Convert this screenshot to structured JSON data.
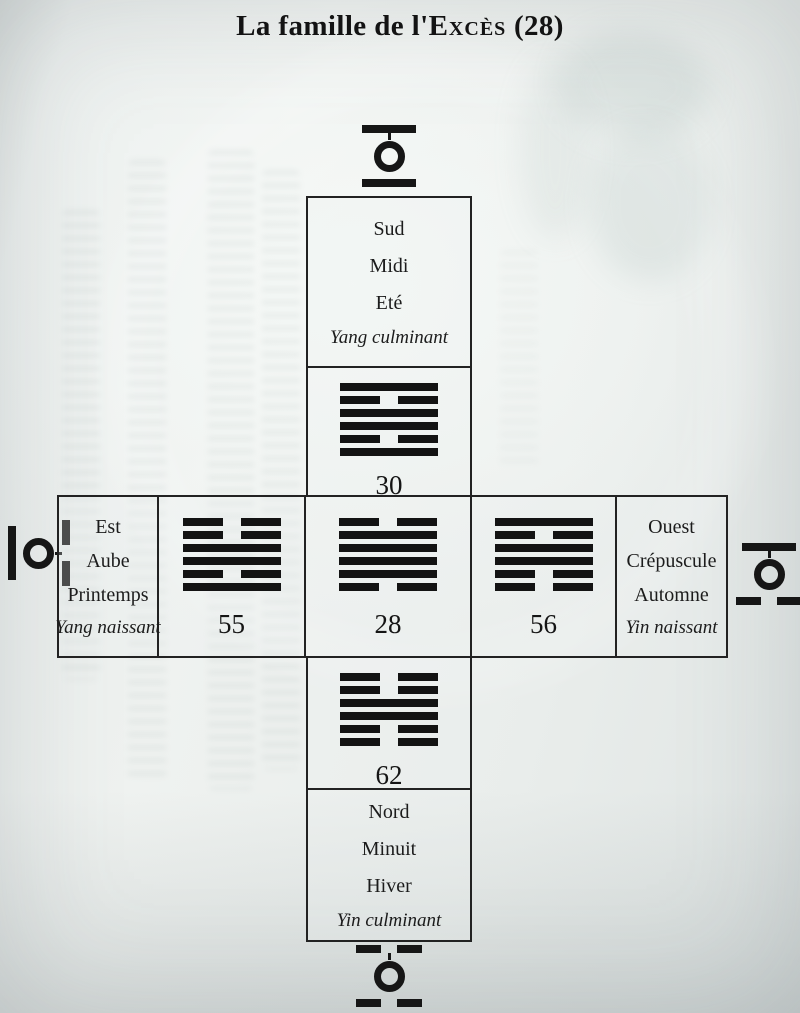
{
  "page": {
    "title_prefix": "La famille de l'",
    "title_smallcaps": "Excès",
    "title_suffix": " (28)"
  },
  "colors": {
    "ink": "#1a1a1a",
    "paper": "#e9edec"
  },
  "directions": {
    "south": {
      "lines": [
        "Sud",
        "Midi",
        "Eté"
      ],
      "note": "Yang culminant"
    },
    "east": {
      "lines": [
        "Est",
        "Aube",
        "Printemps"
      ],
      "note": "Yang naissant"
    },
    "west": {
      "lines": [
        "Ouest",
        "Crépuscule",
        "Automne"
      ],
      "note": "Yin naissant"
    },
    "north": {
      "lines": [
        "Nord",
        "Minuit",
        "Hiver"
      ],
      "note": "Yin culminant"
    }
  },
  "hexagrams": {
    "h30": {
      "number": "30",
      "lines_top_to_bottom": [
        "solid",
        "broken",
        "solid",
        "solid",
        "broken",
        "solid"
      ]
    },
    "h55": {
      "number": "55",
      "lines_top_to_bottom": [
        "broken",
        "broken",
        "solid",
        "solid",
        "broken",
        "solid"
      ]
    },
    "h28": {
      "number": "28",
      "lines_top_to_bottom": [
        "broken",
        "solid",
        "solid",
        "solid",
        "solid",
        "broken"
      ]
    },
    "h56": {
      "number": "56",
      "lines_top_to_bottom": [
        "solid",
        "broken",
        "solid",
        "solid",
        "broken",
        "broken"
      ]
    },
    "h62": {
      "number": "62",
      "lines_top_to_bottom": [
        "broken",
        "broken",
        "solid",
        "solid",
        "broken",
        "broken"
      ]
    }
  },
  "emblems": {
    "top": {
      "orientation": "horizontal",
      "first": "solid",
      "second": "solid",
      "tick": "first"
    },
    "right": {
      "orientation": "horizontal",
      "first": "solid",
      "second": "broken",
      "tick": "first"
    },
    "bottom": {
      "orientation": "horizontal",
      "first": "broken",
      "second": "broken",
      "tick": "first"
    },
    "left": {
      "orientation": "vertical",
      "first": "solid",
      "second": "broken",
      "tick": "second"
    }
  }
}
